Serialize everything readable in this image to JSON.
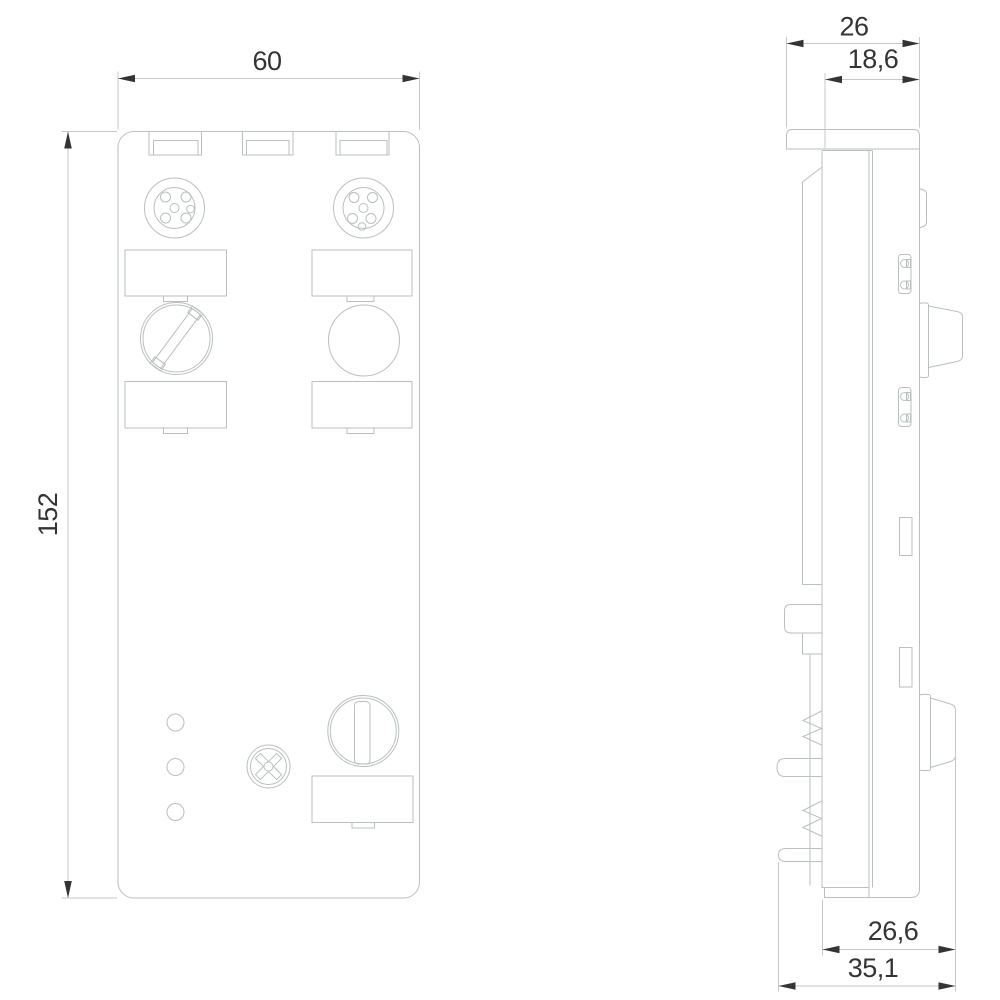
{
  "dims": {
    "front_width": "60",
    "front_height": "152",
    "side_top_total": "26",
    "side_top_inner": "18,6",
    "side_bottom_inner": "26,6",
    "side_bottom_total": "35,1"
  }
}
